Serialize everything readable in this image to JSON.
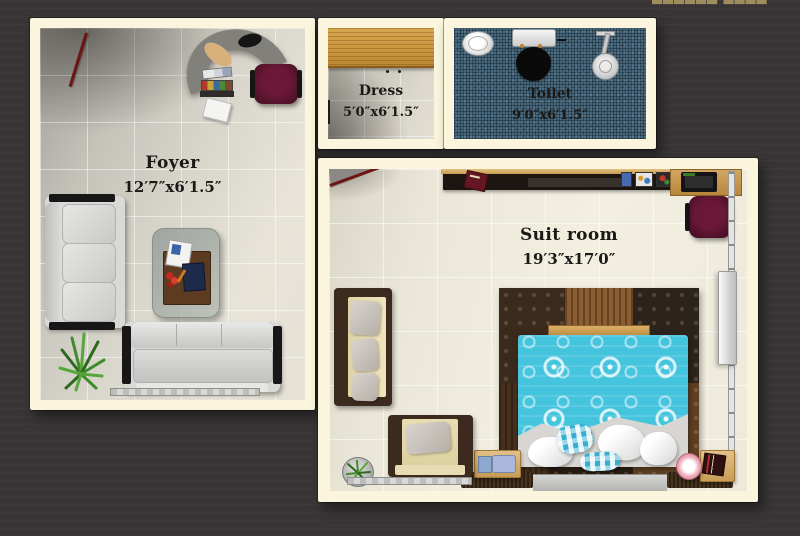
{
  "watermark": {
    "text": "▆▆▆▆▆▆ ▆▆▆▆ ▆▆▆",
    "color": "#9d8d5f"
  },
  "rooms": {
    "foyer": {
      "name": "Foyer",
      "dimensions": "12′7″x6′1.5″"
    },
    "dress": {
      "name": "Dress",
      "dimensions": "5′0″x6′1.5″"
    },
    "toilet": {
      "name": "Toilet",
      "dimensions": "9′0″x6′1.5″"
    },
    "suit": {
      "name": "Suit room",
      "dimensions": "19′3″x17′0″"
    }
  },
  "palette": {
    "background": "#393536",
    "wall": "#faf5dc",
    "label_text": "#1b1916",
    "toilet_floor": "#46687f",
    "bed_accent": "#45c4de",
    "wood": "#c6923e",
    "door_red": "#6e1412"
  }
}
